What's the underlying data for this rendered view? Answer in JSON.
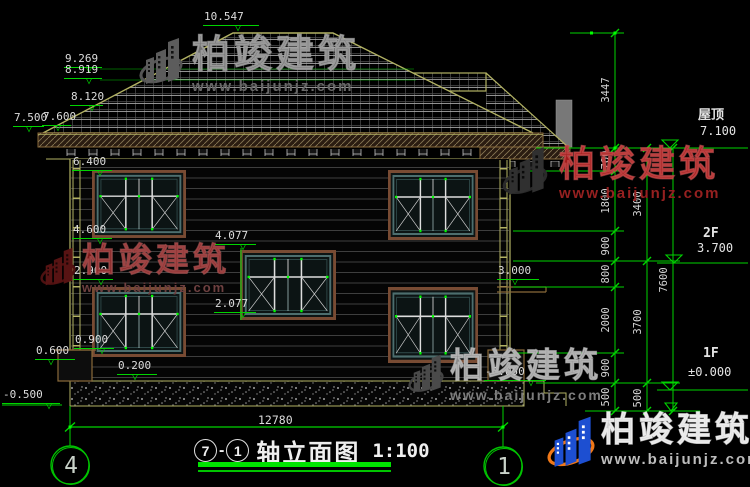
{
  "watermark": {
    "brand": "柏竣建筑",
    "url": "www.baijunjz.com"
  },
  "title": {
    "axis_from": "7",
    "dash": "-",
    "axis_to": "1",
    "text": "轴立面图",
    "scale": "1:100"
  },
  "bottom_dim": {
    "value": "12780"
  },
  "colors": {
    "dim_green": "#00d400",
    "grip_green": "#00ff00",
    "text": "#dcdcdc",
    "roof_outline": "#b2b263",
    "tile_grid": "#909090",
    "eave_brown": "#8a6a3a",
    "window_frame": "#784b33",
    "window_sash": "#4d6e6e",
    "wm_gray": "#8a8a8a",
    "wm_red": "#a11c1c",
    "logo_blue": "#1d4fd1",
    "logo_orange": "#f07818"
  },
  "levels": [
    {
      "v": "10.547",
      "x": 203,
      "y": 9,
      "w": 56,
      "t": 32
    },
    {
      "v": "9.269",
      "x": 64,
      "y": 51,
      "w": 38,
      "t": 22
    },
    {
      "v": "8.919",
      "x": 64,
      "y": 62,
      "w": 38,
      "t": 22
    },
    {
      "v": "8.120",
      "x": 70,
      "y": 89,
      "w": 33,
      "t": 19
    },
    {
      "v": "7.500",
      "x": 13,
      "y": 110,
      "w": 31,
      "t": 13
    },
    {
      "v": "7.600",
      "x": 42,
      "y": 109,
      "w": 29,
      "t": 13
    },
    {
      "v": "6.400",
      "x": 72,
      "y": 154,
      "w": 40,
      "t": 25
    },
    {
      "v": "4.600",
      "x": 72,
      "y": 222,
      "w": 40,
      "t": 25
    },
    {
      "v": "4.077",
      "x": 214,
      "y": 228,
      "w": 42,
      "t": 26
    },
    {
      "v": "2.900",
      "x": 73,
      "y": 263,
      "w": 40,
      "t": 25
    },
    {
      "v": "2.077",
      "x": 214,
      "y": 296,
      "w": 42,
      "t": 26
    },
    {
      "v": "3.000",
      "x": 497,
      "y": 263,
      "w": 42,
      "t": 15
    },
    {
      "v": "0.900",
      "x": 74,
      "y": 332,
      "w": 40,
      "t": 25
    },
    {
      "v": "0.600",
      "x": 35,
      "y": 343,
      "w": 40,
      "t": 13
    },
    {
      "v": "0.200",
      "x": 117,
      "y": 358,
      "w": 40,
      "t": 15
    },
    {
      "v": "-0.500",
      "x": 2,
      "y": 387,
      "w": 58,
      "t": 44
    },
    {
      "v": "-0.050",
      "x": 484,
      "y": 364,
      "w": 62,
      "t": 44
    }
  ],
  "levels_right": [
    {
      "name": "屋顶",
      "value": "7.100",
      "nx": 698,
      "ny": 104,
      "vx": 700,
      "vy": 124
    },
    {
      "name": "2F",
      "value": "3.700",
      "nx": 703,
      "ny": 226,
      "vx": 697,
      "vy": 241
    },
    {
      "name": "1F",
      "value": "±0.000",
      "nx": 703,
      "ny": 346,
      "vx": 688,
      "vy": 365
    }
  ],
  "chain_labels": [
    {
      "t": "3447",
      "x": 606,
      "y": 90
    },
    {
      "t": "700",
      "x": 606,
      "y": 160
    },
    {
      "t": "1800",
      "x": 606,
      "y": 201
    },
    {
      "t": "900",
      "x": 606,
      "y": 246
    },
    {
      "t": "800",
      "x": 606,
      "y": 274
    },
    {
      "t": "2000",
      "x": 606,
      "y": 320
    },
    {
      "t": "900",
      "x": 606,
      "y": 368
    },
    {
      "t": "500",
      "x": 606,
      "y": 397
    },
    {
      "t": "3400",
      "x": 638,
      "y": 204
    },
    {
      "t": "3700",
      "x": 638,
      "y": 322
    },
    {
      "t": "500",
      "x": 638,
      "y": 398
    },
    {
      "t": "7600",
      "x": 664,
      "y": 280
    }
  ],
  "axis_bubbles": [
    {
      "label": "4",
      "x": 52,
      "y": 447
    },
    {
      "label": "1",
      "x": 485,
      "y": 448
    }
  ],
  "watermarks": [
    {
      "x": 136,
      "y": 36,
      "lw": 50,
      "lh": 56,
      "bs": 38,
      "us": 15,
      "bc": "#6f6f6f",
      "uc": "#686868",
      "bstroke": "rgba(190,190,190,0.55)",
      "bar": "#5c5c5c",
      "ring": "#555555",
      "win": "#111111"
    },
    {
      "x": 40,
      "y": 243,
      "lw": 36,
      "lh": 52,
      "bs": 33,
      "us": 13,
      "bc": "#7d1a1a",
      "uc": "#6e4040",
      "bstroke": "rgba(200,120,120,0.45)",
      "bar": "#571313",
      "ring": "#4d1111",
      "win": "#1a0505"
    },
    {
      "x": 497,
      "y": 145,
      "lw": 56,
      "lh": 58,
      "bs": 36,
      "us": 15,
      "bc": "#a11c1c",
      "uc": "#962020",
      "bstroke": "rgba(230,120,120,0.4)",
      "bar": "#303030",
      "ring": "#2a2a2a",
      "win": "#0a0a0a"
    },
    {
      "x": 408,
      "y": 349,
      "lw": 36,
      "lh": 54,
      "bs": 34,
      "us": 14,
      "bc": "#8a8a8a",
      "uc": "#7d7d7d",
      "bstroke": "rgba(220,220,220,0.5)",
      "bar": "#4a4a4a",
      "ring": "#444444",
      "win": "#0c0c0c"
    },
    {
      "x": 547,
      "y": 413,
      "lw": 48,
      "lh": 64,
      "bs": 34,
      "us": 15,
      "bc": "#d0d0d0",
      "uc": "#bdbdbd",
      "bstroke": "rgba(255,255,255,0.6)",
      "bar": "#1d4fd1",
      "ring": "#f07818",
      "win": "#ffffff"
    }
  ]
}
